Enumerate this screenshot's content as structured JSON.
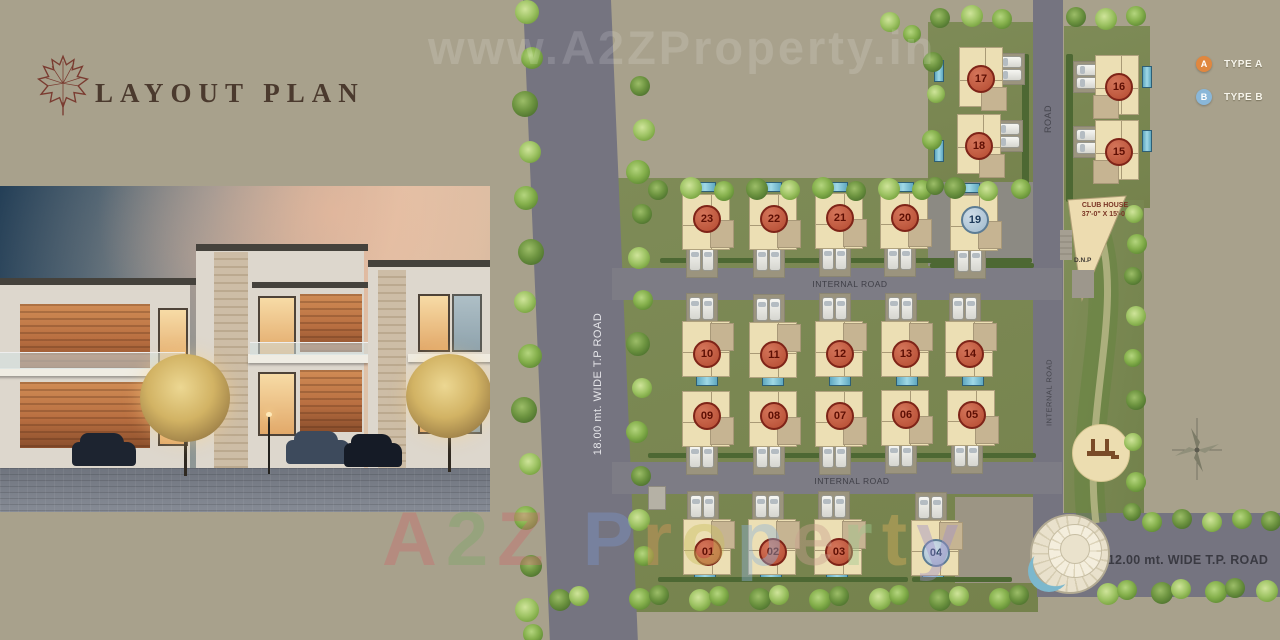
{
  "header": {
    "title": "LAYOUT PLAN",
    "logo": "maple-leaf-icon"
  },
  "legend": {
    "items": [
      {
        "badge": "A",
        "label": "TYPE A",
        "color": "#e0873f"
      },
      {
        "badge": "B",
        "label": "TYPE B",
        "color": "#8ab7d8"
      }
    ]
  },
  "watermarks": {
    "top": "www.A2ZProperty.in",
    "bottom": "A2Z Property"
  },
  "plan": {
    "labels": {
      "road_18mt": "18.00 mt. WIDE T.P ROAD",
      "road_12mt": "12.00 mt. WIDE T.P. ROAD",
      "internal_road": "INTERNAL ROAD",
      "road": "ROAD",
      "club_house_line1": "CLUB HOUSE",
      "club_house_line2": "37'-0\" X 15'-0\"",
      "ramp": "D.N.P"
    },
    "units": [
      {
        "number": "01",
        "type": "A"
      },
      {
        "number": "02",
        "type": "A"
      },
      {
        "number": "03",
        "type": "A"
      },
      {
        "number": "04",
        "type": "B"
      },
      {
        "number": "05",
        "type": "A"
      },
      {
        "number": "06",
        "type": "A"
      },
      {
        "number": "07",
        "type": "A"
      },
      {
        "number": "08",
        "type": "A"
      },
      {
        "number": "09",
        "type": "A"
      },
      {
        "number": "10",
        "type": "A"
      },
      {
        "number": "11",
        "type": "A"
      },
      {
        "number": "12",
        "type": "A"
      },
      {
        "number": "13",
        "type": "A"
      },
      {
        "number": "14",
        "type": "A"
      },
      {
        "number": "15",
        "type": "A"
      },
      {
        "number": "16",
        "type": "A"
      },
      {
        "number": "17",
        "type": "A"
      },
      {
        "number": "18",
        "type": "A"
      },
      {
        "number": "19",
        "type": "B"
      },
      {
        "number": "20",
        "type": "A"
      },
      {
        "number": "21",
        "type": "A"
      },
      {
        "number": "22",
        "type": "A"
      },
      {
        "number": "23",
        "type": "A"
      }
    ]
  },
  "colors": {
    "background": "#a8a18c",
    "road": "#757480",
    "grass": "#7b8a57",
    "house": "#ecdfb4",
    "type_a_badge": "#b44a30",
    "type_b_badge": "#9fb9cc",
    "legend_a": "#e0873f",
    "legend_b": "#8ab7d8",
    "title_text": "#4b3a2e",
    "watermark_letters": [
      "#c86f6f",
      "#7fa86a",
      "#c86f6f",
      "#7b93c9",
      "#d9985a",
      "#c9bf5e",
      "#8fb3d9",
      "#c9a08f",
      "#9fc98f",
      "#d9b05b",
      "#9f8fc9"
    ]
  }
}
